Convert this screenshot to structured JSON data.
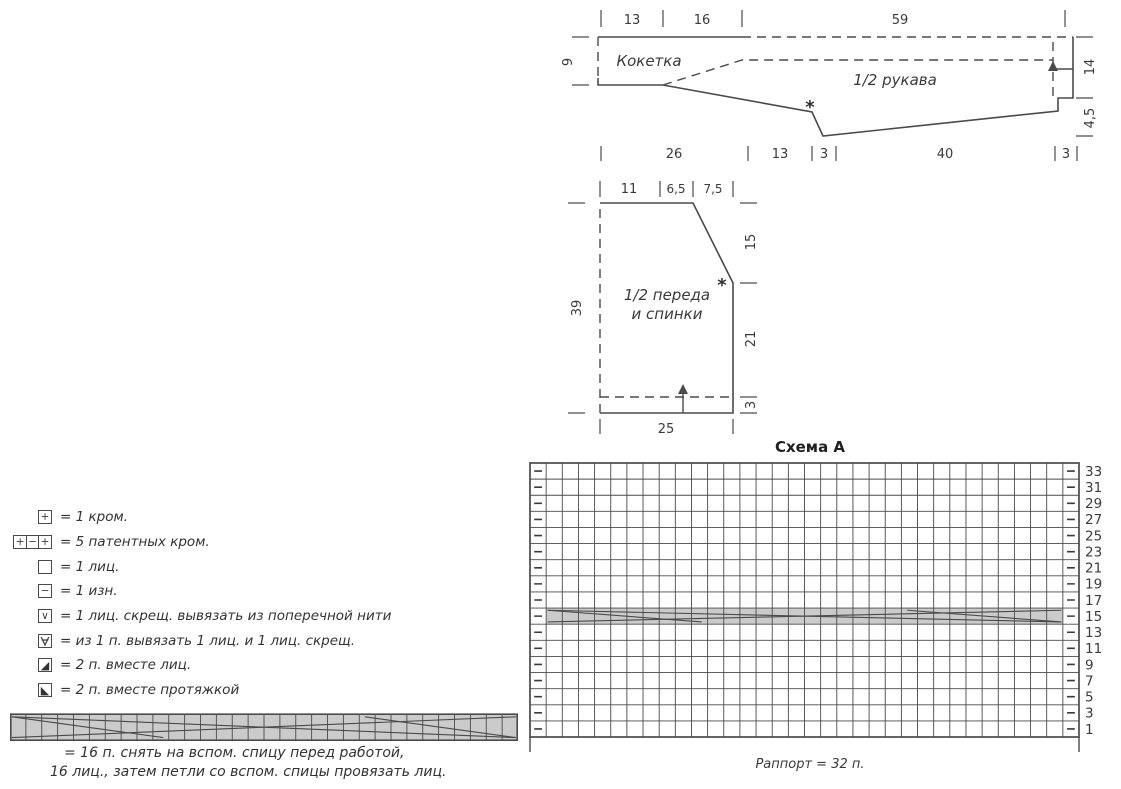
{
  "sleeve": {
    "region_label": "Кокетка",
    "part_label": "1/2 рукава",
    "star": "*",
    "top": {
      "w1": "13",
      "w2": "16",
      "w3": "59"
    },
    "left": {
      "h1": "9"
    },
    "right": {
      "h1": "14",
      "h2": "4,5"
    },
    "bottom": {
      "w1": "26",
      "w2": "13",
      "w3": "3",
      "w4": "40",
      "w5": "3"
    }
  },
  "front_back": {
    "part_label_line1": "1/2 переда",
    "part_label_line2": "и спинки",
    "star": "*",
    "top": {
      "w1": "11",
      "w2": "6,5",
      "w3": "7,5"
    },
    "left": {
      "h1": "39"
    },
    "right": {
      "h1": "15",
      "h2": "21",
      "h3": "3"
    },
    "bottom": {
      "w1": "25"
    }
  },
  "chart": {
    "title": "Схема A",
    "caption": "Раппорт = 32 п.",
    "columns": 34,
    "rows": 17,
    "repeat_stitches": 32,
    "cable_row_number": "15",
    "edge_symbol": "−",
    "row_numbers": [
      "33",
      "31",
      "29",
      "27",
      "25",
      "23",
      "21",
      "19",
      "17",
      "15",
      "13",
      "11",
      "9",
      "7",
      "5",
      "3",
      "1"
    ]
  },
  "legend": {
    "items": [
      {
        "name": "kromka-symbol",
        "type": "boxes",
        "glyphs": [
          "+"
        ],
        "text": "= 1 кром."
      },
      {
        "name": "patent-kromka-symbol",
        "type": "boxes",
        "glyphs": [
          "+",
          "−",
          "+"
        ],
        "text": "= 5 патентных кром."
      },
      {
        "name": "knit-symbol",
        "type": "boxes",
        "glyphs": [
          ""
        ],
        "text": "= 1 лиц."
      },
      {
        "name": "purl-symbol",
        "type": "boxes",
        "glyphs": [
          "−"
        ],
        "text": "= 1 изн."
      },
      {
        "name": "knit-tbl-symbol",
        "type": "boxes",
        "glyphs": [
          "∨"
        ],
        "text": "= 1 лиц. скрещ. вывязать из поперечной нити"
      },
      {
        "name": "increase-symbol",
        "type": "v-crossed",
        "glyphs": [],
        "text": "= из 1 п. вывязать 1 лиц. и 1 лиц. скрещ."
      },
      {
        "name": "k2tog-symbol",
        "type": "boxes",
        "glyphs": [
          "◢"
        ],
        "text": "= 2 п. вместе лиц."
      },
      {
        "name": "ssk-symbol",
        "type": "boxes",
        "glyphs": [
          "◣"
        ],
        "text": "= 2 п. вместе протяжкой"
      }
    ],
    "cable_strip_cells": 32,
    "cable_note_line1": "= 16 п. снять на вспом. спицу перед работой,",
    "cable_note_line2": "16 лиц., затем петли со вспом. спицы провязать лиц."
  },
  "colors": {
    "line": "#4a4a4a",
    "text": "#333333",
    "gray_fill": "#cbcbcb"
  }
}
